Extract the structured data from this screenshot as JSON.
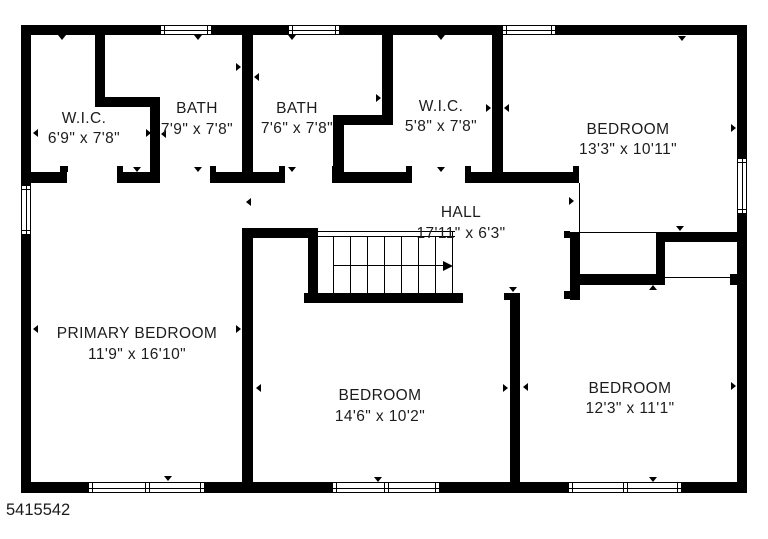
{
  "footer": {
    "floorplan_id": "5415542"
  },
  "palette": {
    "wall": "#000000",
    "text": "#1c1c1c",
    "background": "#ffffff"
  },
  "rooms": [
    {
      "id": "wic-1",
      "name": "W.I.C.",
      "dims": "6'9\" x 7'8\"",
      "cx": 84,
      "name_cy": 119,
      "dims_cy": 139
    },
    {
      "id": "bath-1",
      "name": "BATH",
      "dims": "7'9\" x 7'8\"",
      "cx": 197,
      "name_cy": 109,
      "dims_cy": 130
    },
    {
      "id": "bath-2",
      "name": "BATH",
      "dims": "7'6\" x 7'8\"",
      "cx": 297,
      "name_cy": 109,
      "dims_cy": 129
    },
    {
      "id": "wic-2",
      "name": "W.I.C.",
      "dims": "5'8\" x 7'8\"",
      "cx": 441,
      "name_cy": 107,
      "dims_cy": 127
    },
    {
      "id": "bedroom-top-right",
      "name": "BEDROOM",
      "dims": "13'3\" x 10'11\"",
      "cx": 628,
      "name_cy": 130,
      "dims_cy": 150
    },
    {
      "id": "hall",
      "name": "HALL",
      "dims": "17'11\" x 6'3\"",
      "cx": 461,
      "name_cy": 213,
      "dims_cy": 234
    },
    {
      "id": "primary-bedroom",
      "name": "PRIMARY BEDROOM",
      "dims": "11'9\" x 16'10\"",
      "cx": 137,
      "name_cy": 334,
      "dims_cy": 355
    },
    {
      "id": "bedroom-bottom-middle",
      "name": "BEDROOM",
      "dims": "14'6\" x 10'2\"",
      "cx": 380,
      "name_cy": 396,
      "dims_cy": 417
    },
    {
      "id": "bedroom-bottom-right",
      "name": "BEDROOM",
      "dims": "12'3\" x 11'1\"",
      "cx": 630,
      "name_cy": 389,
      "dims_cy": 409
    }
  ],
  "geometry": {
    "walls": [
      [
        21,
        25,
        726,
        10
      ],
      [
        21,
        482,
        726,
        11
      ],
      [
        21,
        25,
        10,
        468
      ],
      [
        737,
        25,
        10,
        468
      ],
      [
        95,
        25,
        10,
        82
      ],
      [
        95,
        97,
        65,
        10
      ],
      [
        150,
        97,
        10,
        81
      ],
      [
        242,
        25,
        11,
        158
      ],
      [
        382,
        25,
        11,
        100
      ],
      [
        333,
        115,
        60,
        10
      ],
      [
        333,
        115,
        11,
        58
      ],
      [
        492,
        25,
        11,
        158
      ],
      [
        21,
        172,
        46,
        11
      ],
      [
        117,
        172,
        43,
        11
      ],
      [
        210,
        172,
        75,
        11
      ],
      [
        332,
        172,
        80,
        11
      ],
      [
        465,
        172,
        114,
        11
      ],
      [
        242,
        228,
        76,
        10
      ],
      [
        242,
        228,
        11,
        254
      ],
      [
        308,
        238,
        10,
        60
      ],
      [
        304,
        293,
        159,
        10
      ],
      [
        510,
        293,
        10,
        189
      ],
      [
        570,
        232,
        10,
        68
      ],
      [
        656,
        232,
        81,
        10
      ],
      [
        656,
        232,
        9,
        53
      ],
      [
        575,
        274,
        87,
        11
      ],
      [
        730,
        274,
        8,
        11
      ],
      [
        564,
        231,
        6,
        7
      ],
      [
        564,
        291,
        6,
        8
      ],
      [
        504,
        293,
        6,
        7
      ],
      [
        60,
        166,
        8,
        6
      ],
      [
        117,
        166,
        6,
        6
      ],
      [
        210,
        166,
        6,
        6
      ],
      [
        279,
        166,
        6,
        6
      ],
      [
        332,
        166,
        6,
        6
      ],
      [
        406,
        166,
        6,
        6
      ],
      [
        465,
        166,
        6,
        6
      ],
      [
        573,
        166,
        6,
        6
      ]
    ],
    "thin_lines": [
      [
        579,
        183,
        1,
        49
      ],
      [
        580,
        232,
        76,
        1
      ],
      [
        665,
        277,
        65,
        1
      ]
    ],
    "windows": [
      {
        "x": 160,
        "y": 25,
        "w": 52,
        "h": 10,
        "orient": "h",
        "double": false
      },
      {
        "x": 288,
        "y": 25,
        "w": 52,
        "h": 10,
        "orient": "h",
        "double": false
      },
      {
        "x": 502,
        "y": 25,
        "w": 54,
        "h": 10,
        "orient": "h",
        "double": false
      },
      {
        "x": 21,
        "y": 185,
        "w": 10,
        "h": 50,
        "orient": "v",
        "double": false
      },
      {
        "x": 737,
        "y": 158,
        "w": 10,
        "h": 56,
        "orient": "v",
        "double": false
      },
      {
        "x": 88,
        "y": 482,
        "w": 117,
        "h": 11,
        "orient": "h",
        "double": true
      },
      {
        "x": 332,
        "y": 482,
        "w": 108,
        "h": 11,
        "orient": "h",
        "double": true
      },
      {
        "x": 568,
        "y": 482,
        "w": 114,
        "h": 11,
        "orient": "h",
        "double": true
      }
    ],
    "ticks": [
      [
        62,
        35,
        "down"
      ],
      [
        198,
        35,
        "down"
      ],
      [
        292,
        35,
        "down"
      ],
      [
        441,
        35,
        "down"
      ],
      [
        682,
        36,
        "down"
      ],
      [
        137,
        167,
        "down"
      ],
      [
        198,
        167,
        "down"
      ],
      [
        292,
        167,
        "down"
      ],
      [
        441,
        167,
        "down"
      ],
      [
        33,
        133,
        "left"
      ],
      [
        146,
        133,
        "right"
      ],
      [
        161,
        134,
        "left"
      ],
      [
        236,
        67,
        "right"
      ],
      [
        254,
        77,
        "left"
      ],
      [
        376,
        98,
        "right"
      ],
      [
        486,
        108,
        "right"
      ],
      [
        504,
        108,
        "left"
      ],
      [
        731,
        128,
        "right"
      ],
      [
        569,
        201,
        "right"
      ],
      [
        246,
        202,
        "left"
      ],
      [
        680,
        226,
        "down"
      ],
      [
        513,
        287,
        "down"
      ],
      [
        380,
        294,
        "up"
      ],
      [
        653,
        285,
        "up"
      ],
      [
        33,
        329,
        "left"
      ],
      [
        236,
        329,
        "right"
      ],
      [
        256,
        388,
        "left"
      ],
      [
        503,
        388,
        "right"
      ],
      [
        523,
        387,
        "left"
      ],
      [
        731,
        386,
        "right"
      ],
      [
        168,
        476,
        "down"
      ],
      [
        378,
        477,
        "down"
      ],
      [
        653,
        477,
        "down"
      ]
    ],
    "stairs": {
      "top_lines": [
        [
          318,
          231,
          137
        ],
        [
          318,
          236,
          137
        ]
      ],
      "right_edge": [
        452,
        231,
        62
      ],
      "treads_x": [
        333,
        350,
        367,
        384,
        401,
        418,
        435
      ],
      "treads_y1": 236,
      "treads_y2": 293,
      "arrow": {
        "x1": 333,
        "x2": 443,
        "y": 265
      }
    }
  }
}
